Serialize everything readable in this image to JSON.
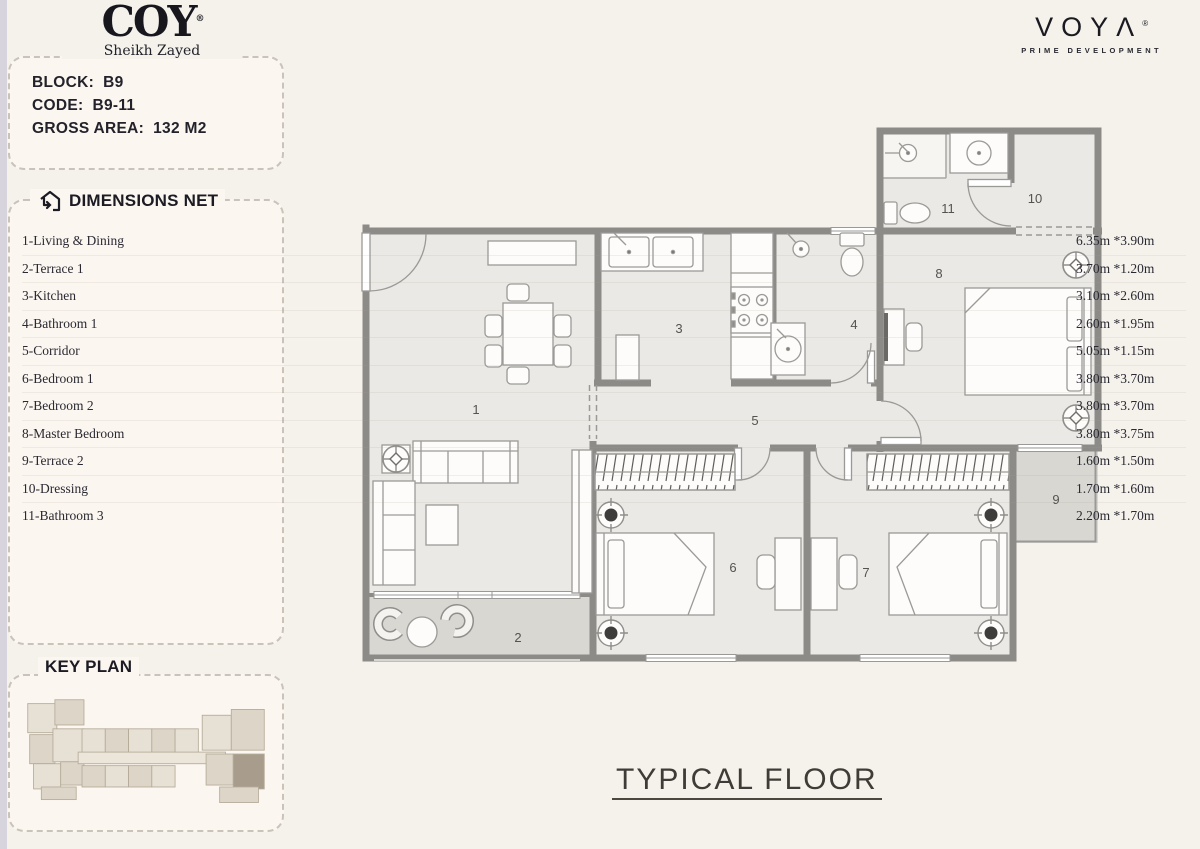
{
  "brand": {
    "coy": {
      "name": "COY",
      "registered": "®",
      "subtitle": "Sheikh Zayed"
    },
    "voya": {
      "name": "VOYΛ",
      "registered": "®",
      "subtitle": "PRIME DEVELOPMENT"
    }
  },
  "unit_info": {
    "rows": [
      {
        "label": "BLOCK:",
        "value": "B9"
      },
      {
        "label": "CODE:",
        "value": "B9-11"
      },
      {
        "label": "GROSS AREA:",
        "value": "132 M2"
      }
    ]
  },
  "dimensions": {
    "title": "DIMENSIONS NET",
    "icon": "house-arrows-icon",
    "rows": [
      {
        "name": "1-Living & Dining",
        "size": "6.35m *3.90m"
      },
      {
        "name": "2-Terrace 1",
        "size": "3.70m *1.20m"
      },
      {
        "name": "3-Kitchen",
        "size": "3.10m *2.60m"
      },
      {
        "name": "4-Bathroom 1",
        "size": "2.60m *1.95m"
      },
      {
        "name": "5-Corridor",
        "size": "5.05m *1.15m"
      },
      {
        "name": "6-Bedroom 1",
        "size": "3.80m *3.70m"
      },
      {
        "name": "7-Bedroom 2",
        "size": "3.80m *3.70m"
      },
      {
        "name": "8-Master Bedroom",
        "size": "3.80m *3.75m"
      },
      {
        "name": "9-Terrace 2",
        "size": "1.60m *1.50m"
      },
      {
        "name": "10-Dressing",
        "size": "1.70m *1.60m"
      },
      {
        "name": "11-Bathroom 3",
        "size": "2.20m *1.70m"
      }
    ]
  },
  "key_plan": {
    "title": "KEY PLAN"
  },
  "floor_plan": {
    "caption": "TYPICAL FLOOR",
    "room_labels": [
      {
        "id": "1",
        "x": 118,
        "y": 291
      },
      {
        "id": "2",
        "x": 160,
        "y": 519
      },
      {
        "id": "3",
        "x": 321,
        "y": 210
      },
      {
        "id": "4",
        "x": 496,
        "y": 206
      },
      {
        "id": "5",
        "x": 397,
        "y": 302
      },
      {
        "id": "6",
        "x": 375,
        "y": 449
      },
      {
        "id": "7",
        "x": 508,
        "y": 454
      },
      {
        "id": "8",
        "x": 581,
        "y": 155
      },
      {
        "id": "9",
        "x": 698,
        "y": 381
      },
      {
        "id": "10",
        "x": 677,
        "y": 80
      },
      {
        "id": "11",
        "x": 590,
        "y": 90
      }
    ]
  },
  "colors": {
    "page_bg": "#f5f2ec",
    "card_bg": "#fbf6f0",
    "wall": "#8d8b88",
    "floor": "#eae9e5",
    "terrace": "#d8d7d2",
    "accent_text": "#1c1b23"
  }
}
